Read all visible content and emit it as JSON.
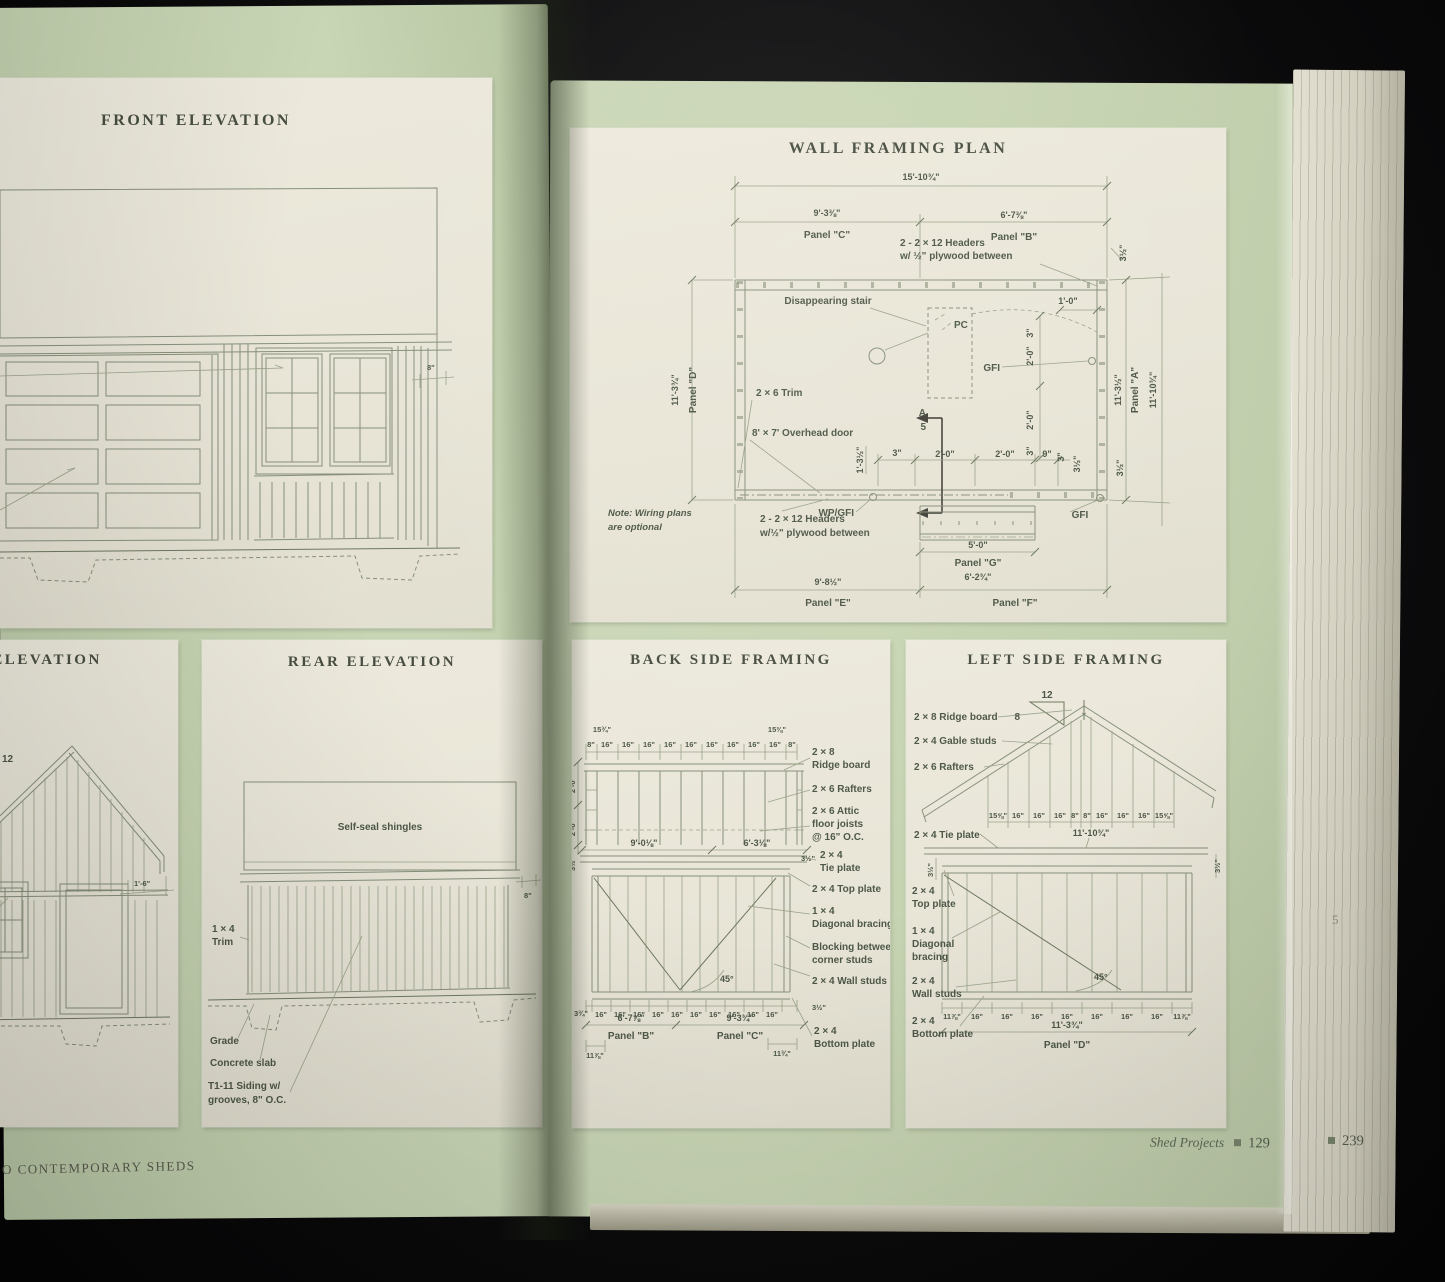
{
  "page": {
    "left_footer": "O CONTEMPORARY SHEDS",
    "right_footer": "Shed Projects",
    "right_num": "129",
    "stack_num": "239",
    "stack_mark": "5",
    "bullet": "■"
  },
  "front": {
    "title": "FRONT ELEVATION",
    "dim8": "8\""
  },
  "side": {
    "title": "DE ELEVATION",
    "s12": "12",
    "dim": "1'-6\""
  },
  "rear": {
    "title": "REAR ELEVATION",
    "shingles": "Self-seal shingles",
    "dim8": "8\"",
    "trim1": "1 × 4",
    "trim2": "Trim",
    "grade": "Grade",
    "slab": "Concrete slab",
    "siding1": "T1-11 Siding w/",
    "siding2": "grooves, 8\" O.C."
  },
  "wall": {
    "title": "WALL FRAMING PLAN",
    "total": "15'-10¾\"",
    "dimC": "9'-3⅜\"",
    "panelC": "Panel \"C\"",
    "dimB": "6'-7⅜\"",
    "panelB": "Panel \"B\"",
    "hdr1": "2 - 2 × 12 Headers",
    "hdr2": "w/ ½\" plywood between",
    "d35a": "3½\"",
    "d35b": "3½\"",
    "d35c": "3½\"",
    "stair": "Disappearing stair",
    "pc": "PC",
    "d10": "1'-0\"",
    "gfi1": "GFI",
    "gfi2": "GFI",
    "gfi3": "GFI",
    "wpgfi": "WP/GFI",
    "dimD": "11'-3¾\"",
    "panelD": "Panel \"D\"",
    "dimA1": "11'-3½\"",
    "panelA": "Panel \"A\"",
    "dimA2": "11'-10¾\"",
    "trim": "2 × 6 Trim",
    "door": "8' × 7' Overhead door",
    "mkA": "A",
    "mk5": "5",
    "d135": "1'-3½\"",
    "d3a": "3\"",
    "d3b": "3\"",
    "d3c": "3\"",
    "d3d": "3\"",
    "d20a": "2'-0\"",
    "d20b": "2'-0\"",
    "d20c": "2'-0\"",
    "d20d": "2'-0\"",
    "d9": "9\"",
    "hdr3": "2 - 2 × 12 Headers",
    "hdr4": "w/½\" plywood between",
    "note1": "Note: Wiring plans",
    "note2": "are optional",
    "d50": "5'-0\"",
    "panelG": "Panel \"G\"",
    "dimG": "6'-2¾\"",
    "dimE": "9'-8½\"",
    "panelE": "Panel \"E\"",
    "panelF": "Panel \"F\""
  },
  "back": {
    "title": "BACK SIDE FRAMING",
    "tl": "15¾\"",
    "tr": "15⅜\"",
    "top_row": [
      "8\"",
      "16\"",
      "16\"",
      "16\"",
      "16\"",
      "16\"",
      "16\"",
      "16\"",
      "16\"",
      "16\"",
      "8\""
    ],
    "left1": "2'-0\"",
    "left2": "2'-0\"",
    "left3": "3½\"",
    "ridge1": "2 × 8",
    "ridge2": "Ridge board",
    "rafters": "2 × 6 Rafters",
    "attic1": "2 × 6 Attic",
    "attic2": "floor joists",
    "attic3": "@ 16\" O.C.",
    "mid1": "9'-0⅛\"",
    "mid2": "6'-3⅛\"",
    "tie1": "2 × 4",
    "tie2": "Tie plate",
    "tie3": "3½\"",
    "top_plate": "2 × 4 Top plate",
    "diag1": "1 × 4",
    "diag2": "Diagonal bracing",
    "block1": "Blocking between",
    "block2": "corner studs",
    "angle": "45°",
    "studs": "2 × 4 Wall studs",
    "bl": "3¾\"",
    "br": "3½\"",
    "bottom_row": [
      "16\"",
      "16\"",
      "16\"",
      "16\"",
      "16\"",
      "16\"",
      "16\"",
      "16\"",
      "16\"",
      "16\""
    ],
    "dimB": "6'-7⅞\"",
    "panelB": "Panel \"B\"",
    "dimC": "9'-3¾\"",
    "panelC": "Panel \"C\"",
    "cl": "11⅞\"",
    "cr": "11¾\"",
    "bot1": "2 × 4",
    "bot2": "Bottom plate"
  },
  "leftf": {
    "title": "LEFT SIDE FRAMING",
    "s12": "12",
    "s8": "8",
    "ridge": "2 × 8 Ridge board",
    "gable": "2 × 4 Gable studs",
    "rafters": "2 × 6 Rafters",
    "row": [
      "15⅝\"",
      "16\"",
      "16\"",
      "16\"",
      "8\"",
      "8\"",
      "16\"",
      "16\"",
      "16\"",
      "15⅝\""
    ],
    "tie": "2 × 4 Tie plate",
    "dimtie": "11'-10¾\"",
    "d35l": "3½\"",
    "d35r": "3½\"",
    "top1": "2 × 4",
    "top2": "Top plate",
    "diag1": "1 × 4",
    "diag2": "Diagonal",
    "diag3": "bracing",
    "studs1": "2 × 4",
    "studs2": "Wall studs",
    "bot1": "2 × 4",
    "bot2": "Bottom plate",
    "angle": "45°",
    "brow": [
      "11⅞\"",
      "16\"",
      "16\"",
      "16\"",
      "16\"",
      "16\"",
      "16\"",
      "16\"",
      "11⅞\""
    ],
    "total": "11'-3¾\"",
    "panelD": "Panel \"D\""
  }
}
